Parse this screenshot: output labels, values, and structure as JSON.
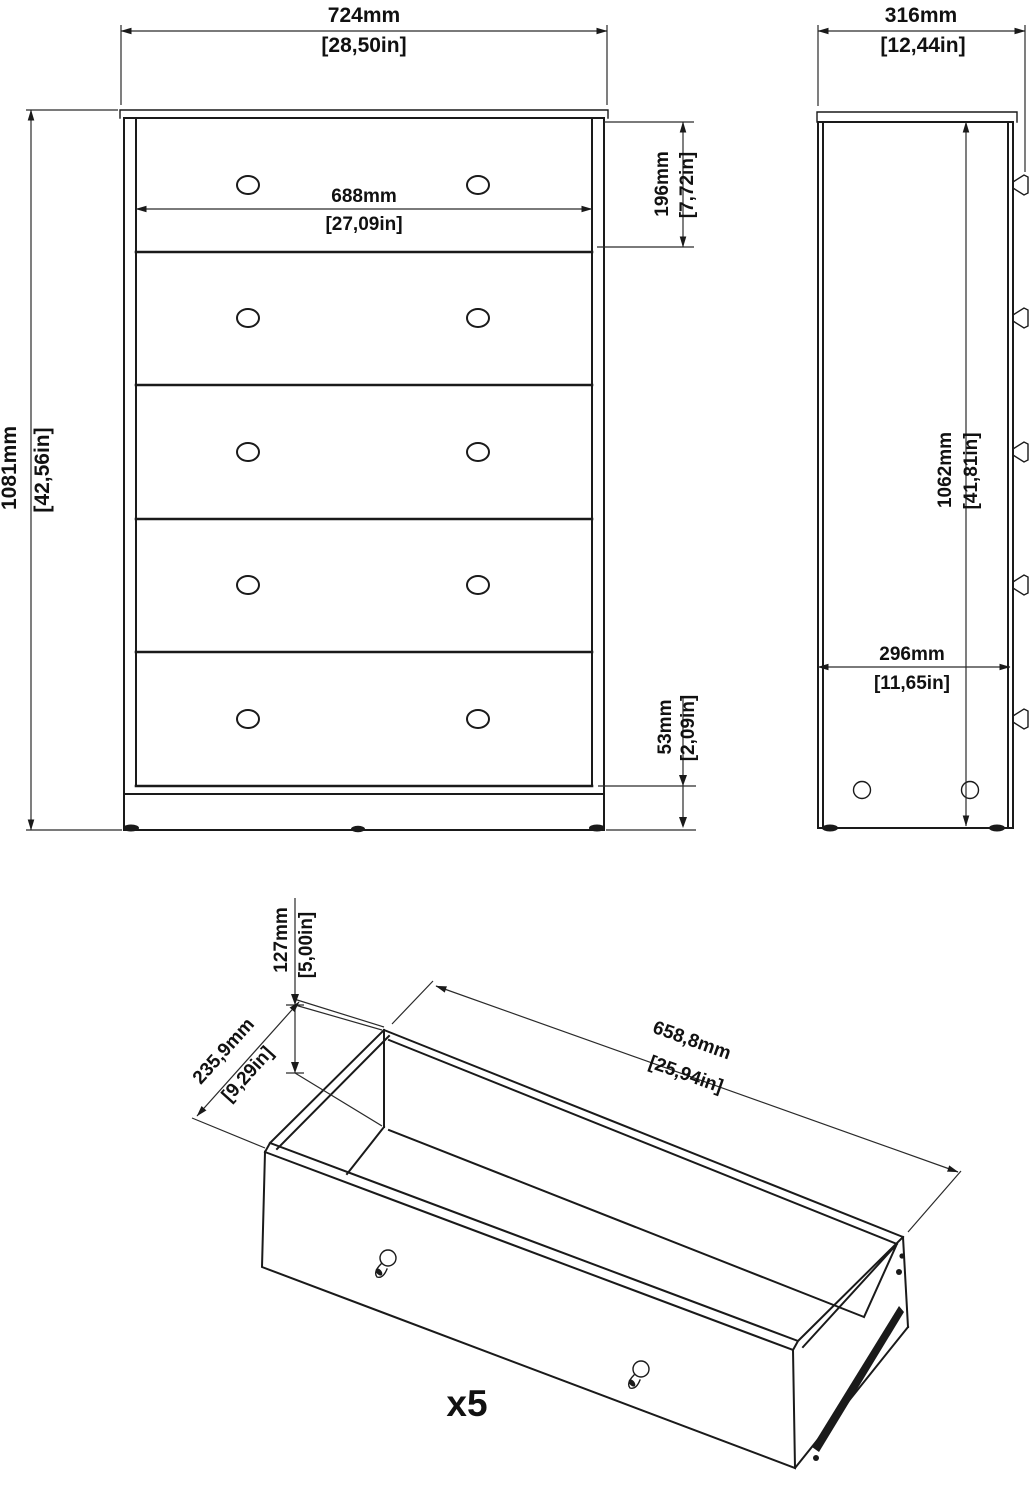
{
  "drawing": {
    "type": "furniture assembly dimension drawing",
    "subject": "5-drawer chest of drawers",
    "views": [
      "front",
      "side",
      "drawer-isometric"
    ]
  },
  "dims": {
    "overall_width": {
      "mm": "724mm",
      "inch": "[28,50in]"
    },
    "overall_height": {
      "mm": "1081mm",
      "inch": "[42,56in]"
    },
    "handle_spacing": {
      "mm": "688mm",
      "inch": "[27,09in]"
    },
    "top_drawer_height": {
      "mm": "196mm",
      "inch": "[7,72in]"
    },
    "bottom_gap": {
      "mm": "53mm",
      "inch": "[2,09in]"
    },
    "overall_depth": {
      "mm": "316mm",
      "inch": "[12,44in]"
    },
    "interior_height": {
      "mm": "1062mm",
      "inch": "[41,81in]"
    },
    "base_depth": {
      "mm": "296mm",
      "inch": "[11,65in]"
    },
    "drawer_height": {
      "mm": "127mm",
      "inch": "[5,00in]"
    },
    "drawer_depth": {
      "mm": "235,9mm",
      "inch": "[9,29in]"
    },
    "drawer_width": {
      "mm": "658,8mm",
      "inch": "[25,94in]"
    }
  },
  "drawer": {
    "quantity_label": "x5"
  },
  "colors": {
    "line": "#1a1a1a",
    "background": "#ffffff"
  }
}
